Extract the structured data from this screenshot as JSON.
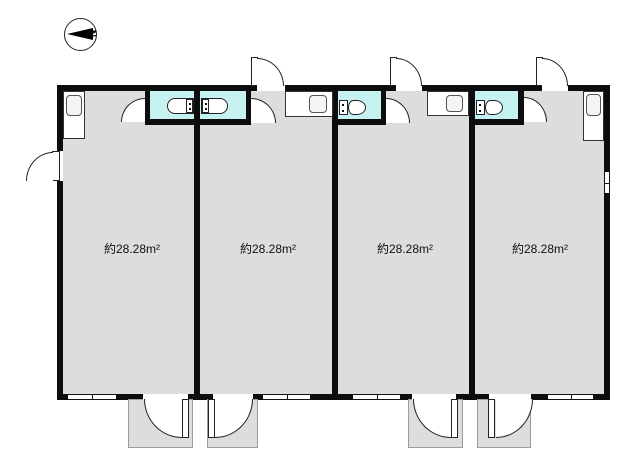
{
  "compass": {
    "north_label": "N"
  },
  "units": [
    {
      "name": "unit-1",
      "area_label": "約28.28m²"
    },
    {
      "name": "unit-2",
      "area_label": "約28.28m²"
    },
    {
      "name": "unit-3",
      "area_label": "約28.28m²"
    },
    {
      "name": "unit-4",
      "area_label": "約28.28m²"
    }
  ],
  "icons": {
    "compass": "north-arrow-icon",
    "bathroom_units_1_2": "bathtub-icon",
    "bathroom_units_3_4": "toilet-icon",
    "kitchen": "kitchen-sink-icon",
    "doors": "door-swing-arc",
    "openings": "window"
  },
  "colors": {
    "room_fill": "#dcdddd",
    "bathroom_fill": "#c5f1f1",
    "wall": "#0d0d0d",
    "porch_fill": "#dcdddd"
  }
}
